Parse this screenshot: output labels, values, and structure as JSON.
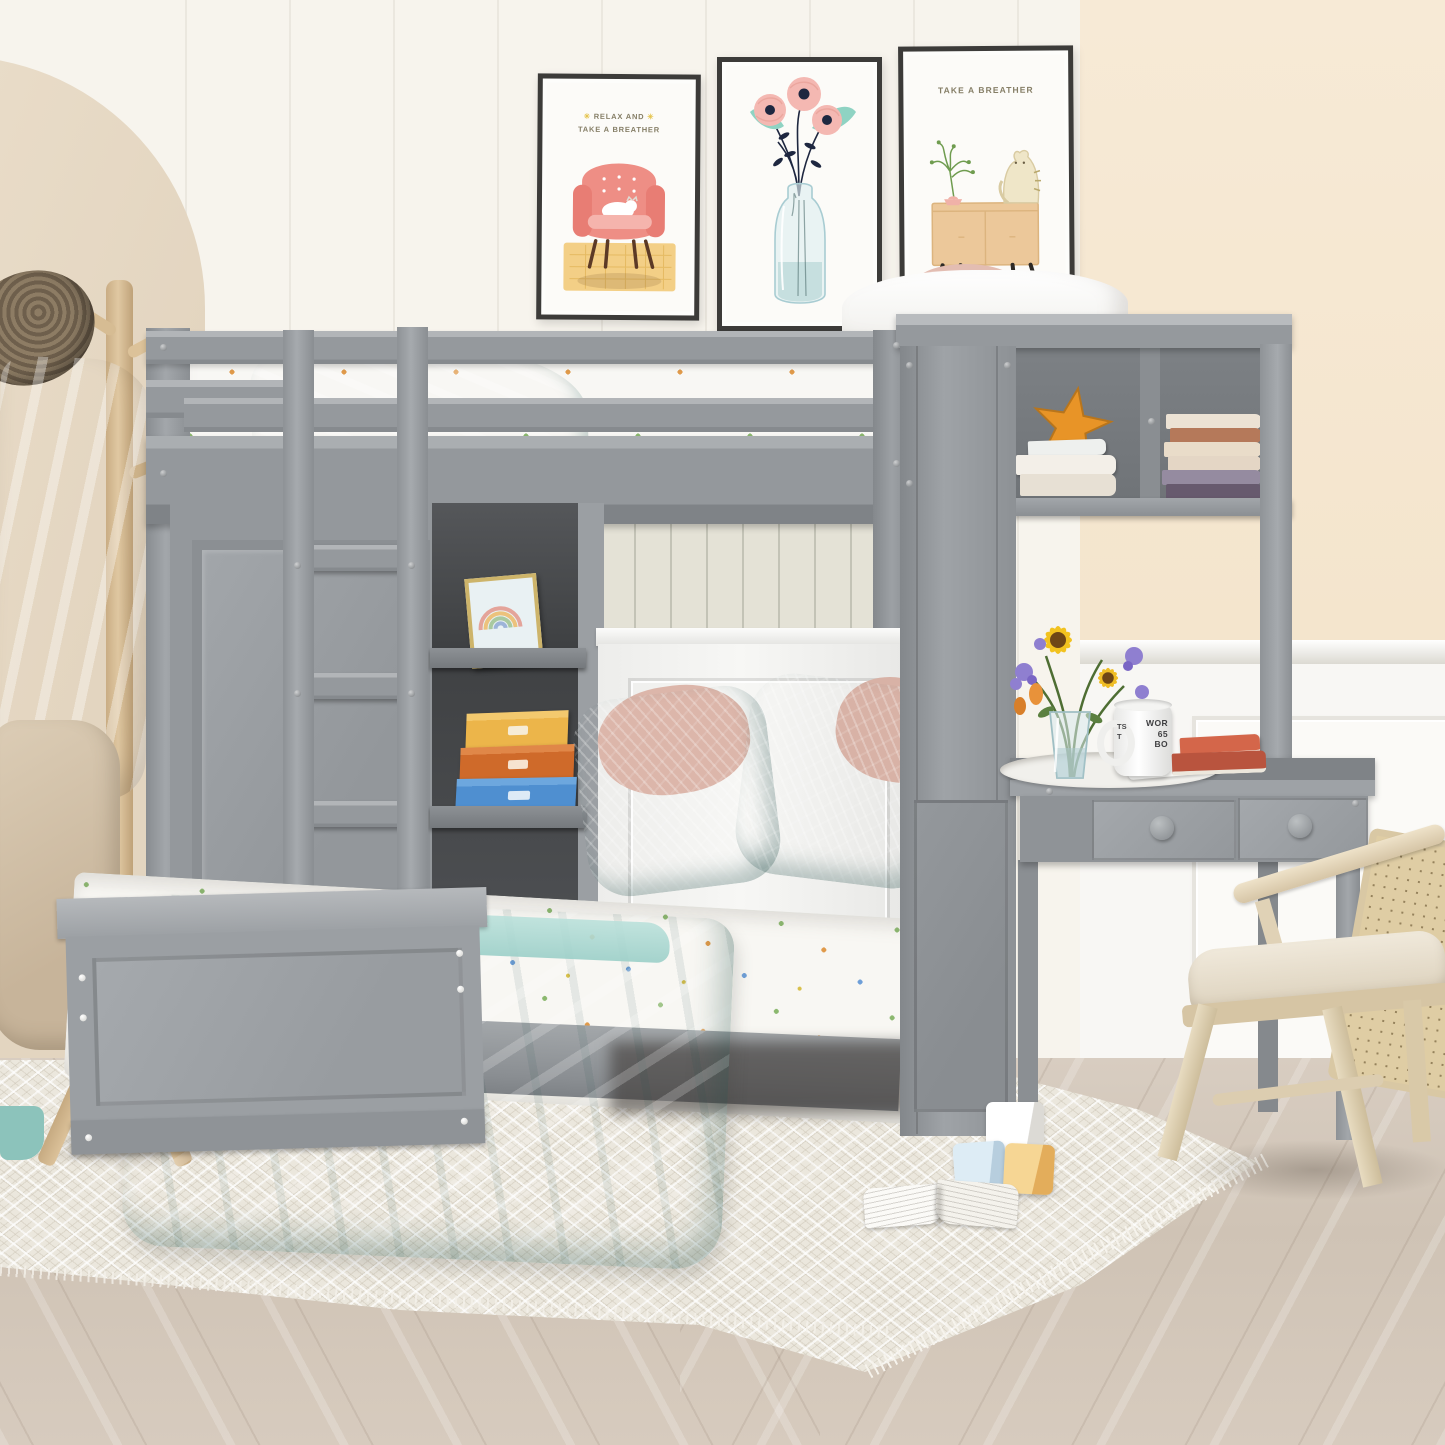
{
  "scene": {
    "description": "Product photo: gray wooden twin loft bunk bed with a perpendicular twin bed below, built-in wardrobe, open cubby shelves, bookcase hutch and writing desk, styled in a beige kids bedroom with posters, coat rack, rattan chair, rug and toys",
    "palette": {
      "furniture_gray": "#969a9e",
      "furniture_gray_dark": "#84888c",
      "teal_bedding": "#84bab2",
      "wall_cream": "#f6f2ea",
      "wall_beige_arch": "#e7dac6",
      "wall_right_peach": "#f4e6ce",
      "beadboard": "#e3e1d5",
      "floor_wood": "#d2c6b9",
      "rug": "#ebe7dd",
      "rattan": "#dfcda4",
      "pink_pillow": "#d9b3a8",
      "box_yellow": "#ecb54a",
      "box_orange": "#cf6a2a",
      "box_blue": "#4f8fd0",
      "book_red": "#cc5a3c",
      "starfish_orange": "#e89427",
      "sunflower_yellow": "#f2c21f"
    }
  },
  "posters": {
    "left": {
      "line1": "RELAX AND",
      "line2": "TAKE A BREATHER"
    },
    "right": {
      "title": "TAKE A BREATHER"
    }
  },
  "desk": {
    "mug": {
      "side_fragments": [
        "TS",
        "T"
      ],
      "lines": [
        "WOR",
        "65",
        "BO"
      ]
    }
  }
}
